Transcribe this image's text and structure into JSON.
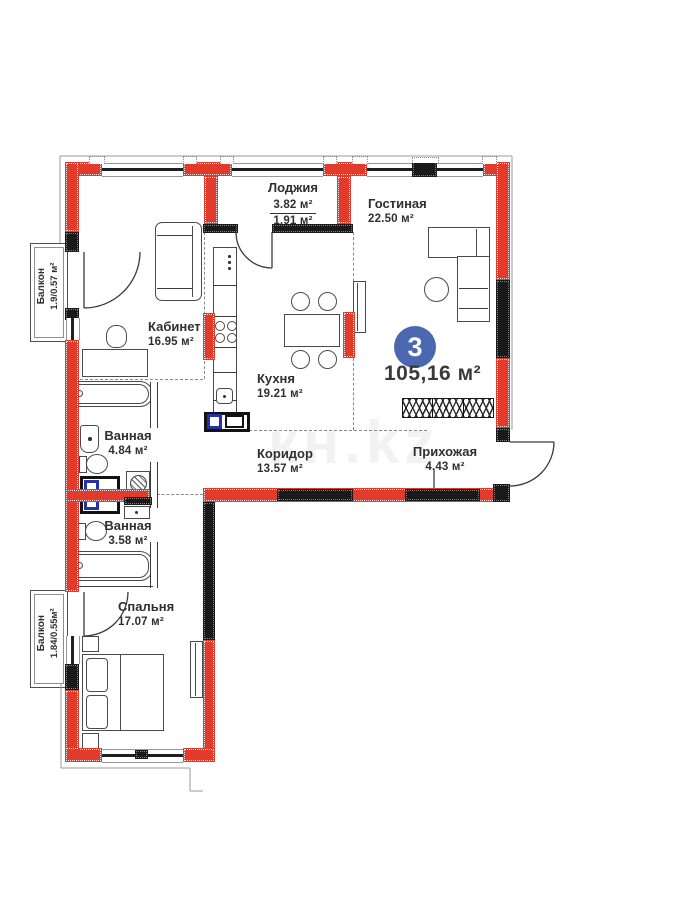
{
  "badge": {
    "rooms_count": "3",
    "total_area": "105,16 м²"
  },
  "rooms": {
    "loggia": {
      "name": "Лоджия",
      "area_upper": "3.82 м²",
      "area_lower": "1.91 м²"
    },
    "living": {
      "name": "Гостиная",
      "area": "22.50 м²"
    },
    "office": {
      "name": "Кабинет",
      "area": "16.95 м²"
    },
    "kitchen": {
      "name": "Кухня",
      "area": "19.21 м²"
    },
    "bath1": {
      "name": "Ванная",
      "area": "4.84 м²"
    },
    "bath2": {
      "name": "Ванная",
      "area": "3.58 м²"
    },
    "corridor": {
      "name": "Коридор",
      "area": "13.57 м²"
    },
    "hall": {
      "name": "Прихожая",
      "area": "4.43 м²"
    },
    "bedroom": {
      "name": "Спальня",
      "area": "17.07 м²"
    },
    "balcony1": {
      "name": "Балкон",
      "area": "1.9/0.57 м²"
    },
    "balcony2": {
      "name": "Балкон",
      "area": "1.84/0.55м²"
    }
  },
  "watermark": "кн.kz",
  "colors": {
    "wall_red": "#e23b2b",
    "wall_black": "#1a1a1a",
    "vent_blue": "#2631a6",
    "badge_blue": "#4b67b0",
    "label_color": "#2f2f2f"
  }
}
